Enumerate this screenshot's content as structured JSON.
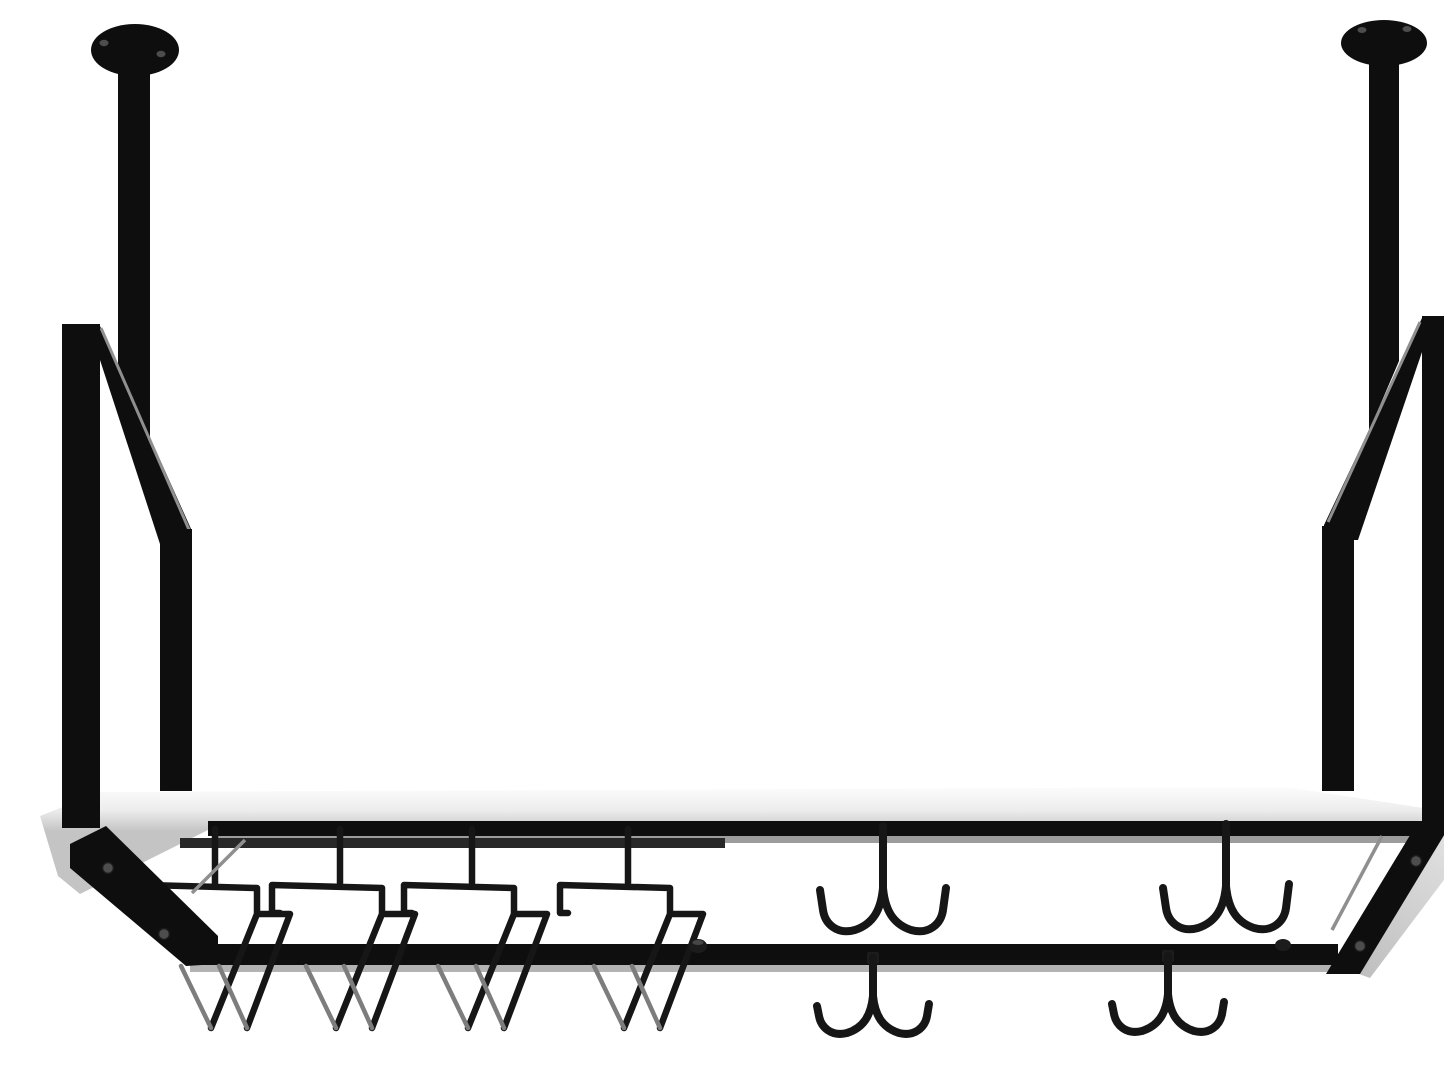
{
  "scene": {
    "type": "product-photo",
    "description": "Ceiling-mounted black metal hanging pot rack with a white shelf board, four stemware wine-glass rails on the left and four double J-hooks on the right, suspended by two ceiling poles with round mounting flanges",
    "background": "#ffffff"
  },
  "colors": {
    "background": "#ffffff",
    "metal": "#0e0e0e",
    "metal-soft": "#1c1c1c",
    "wire": "#161616",
    "sheen": "#7d7d7d",
    "highlight": "#8f8f8f",
    "board-light": "#fbfbfb",
    "board-dark": "#c6c6c6",
    "board-edge": "#d9d9d9",
    "trim-gray": "#9c9c9c",
    "trim-light": "#b3b3b3",
    "mount-bar": "#282828",
    "screw": "#4d4d4d"
  },
  "parts": {
    "left_flange": "round ceiling mounting plate (left)",
    "right_flange": "round ceiling mounting plate (right)",
    "left_pole": "hanging support pole (left)",
    "right_pole": "hanging support pole (right)",
    "left_upright": "front upright bar (left)",
    "right_upright": "front upright bar (right)",
    "left_brace": "diagonal support brace (left)",
    "right_brace": "diagonal support brace (right)",
    "shelf_board": "white shelf board",
    "frame_back_rail": "black frame back rail",
    "frame_front_rail": "black frame front rail",
    "left_end_cap": "frame left end bracket",
    "right_end_cap": "frame right end bracket",
    "stemware_rails": "wine glass stemware rails (4)",
    "upper_hooks": "double J-hooks on back rail (2)",
    "lower_hooks": "double J-hooks on front rail (2)"
  }
}
